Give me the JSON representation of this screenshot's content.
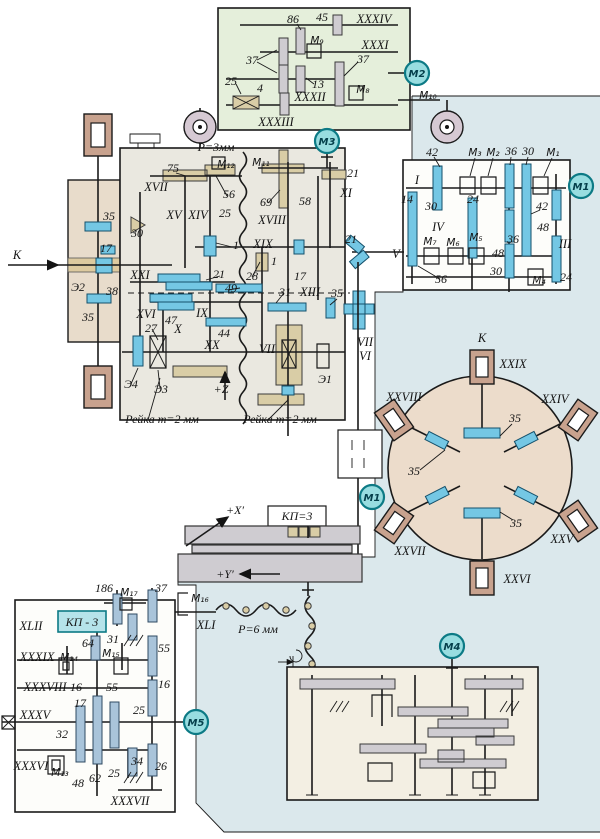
{
  "colors": {
    "line": "#1a1a1a",
    "blue_bg": "#dbe8ec",
    "green_box": "#e5efdb",
    "main_box": "#eae8e0",
    "tan_box": "#e8dccb",
    "circle_fill": "#ecdccb",
    "cream_box": "#f3efe3",
    "white_box": "#fdfdfa",
    "gear_blue": "#74c7e4",
    "gear_tan": "#d9cda6",
    "gear_gray": "#cfccd1",
    "gear_steel": "#a9c4da",
    "frame_brown": "#c8a28e",
    "motor_fill": "#98dde0",
    "motor_stroke": "#0c7a85",
    "kp_fill": "#b5e3ea",
    "pulley_fill": "#d6c9d3"
  },
  "labels": {
    "n1": "1",
    "n4": "4",
    "n13": "13",
    "n14": "14",
    "n16": "16",
    "n17": "17",
    "n21": "21",
    "n24": "24",
    "n25": "25",
    "n26": "26",
    "n27": "27",
    "n28": "28",
    "n30": "30",
    "n31": "31",
    "n32": "32",
    "n34": "34",
    "n35": "35",
    "n36": "36",
    "n37": "37",
    "n38": "38",
    "n42": "42",
    "n44": "44",
    "n45": "45",
    "n47": "47",
    "n48": "48",
    "n49": "49",
    "n55": "55",
    "n56": "56",
    "n58": "58",
    "n62": "62",
    "n64": "64",
    "n69": "69",
    "n75": "75",
    "n86": "86",
    "n186": "186",
    "rI": "I",
    "rIII": "III",
    "rIV": "IV",
    "rV": "V",
    "rVI": "VI",
    "rVII": "VII",
    "rIX": "IX",
    "rX": "X",
    "rXI": "XI",
    "rXIII": "XIII",
    "rXIV": "XIV",
    "rXV": "XV",
    "rXVI": "XVI",
    "rXVII": "XVII",
    "rXVIII": "XVIII",
    "rXIX": "XIX",
    "rXX": "XX",
    "rXXI": "XXI",
    "rXXIV": "XXIV",
    "rXXV": "XXV",
    "rXXVI": "XXVI",
    "rXXVII": "XXVII",
    "rXXVIII": "XXVIII",
    "rXXIX": "XXIX",
    "rXXXI": "XXXI",
    "rXXXII": "XXXII",
    "rXXXIII": "XXXIII",
    "rXXXIV": "XXXIV",
    "rXXXV": "XXXV",
    "rXXXVI": "XXXVI",
    "rXXXVII": "XXXVII",
    "rXXXVIII": "XXXVIII",
    "rXXXIX": "XXXIX",
    "rXLI": "XLI",
    "rXLII": "XLII",
    "m1": "М₁",
    "m2": "М₂",
    "m3": "М₃",
    "m4": "М₄",
    "m5": "М₅",
    "m6": "М₆",
    "m7": "М₇",
    "m8": "М₈",
    "m9": "М₉",
    "m10": "М₁₀",
    "m11": "М₁₁",
    "m12": "М₁₂",
    "m13": "М₁₃",
    "m14": "М₁₄",
    "m15": "М₁₅",
    "m16": "М₁₆",
    "m17": "М₁₇",
    "mot1": "М1",
    "mot2": "М2",
    "mot3": "М3",
    "mot4": "М4",
    "mot5": "М5",
    "e1": "Э1",
    "e2": "Э2",
    "e3": "Э3",
    "e4": "Э4",
    "k": "K",
    "p3": "Р=3мм",
    "p6": "Р=6 мм",
    "rack": "Рейка m=2 мм",
    "kpEq": "КП=3",
    "kpBox": "КП - 3",
    "pZ": "+Z",
    "pX": "+X′",
    "pY": "+Y′"
  }
}
